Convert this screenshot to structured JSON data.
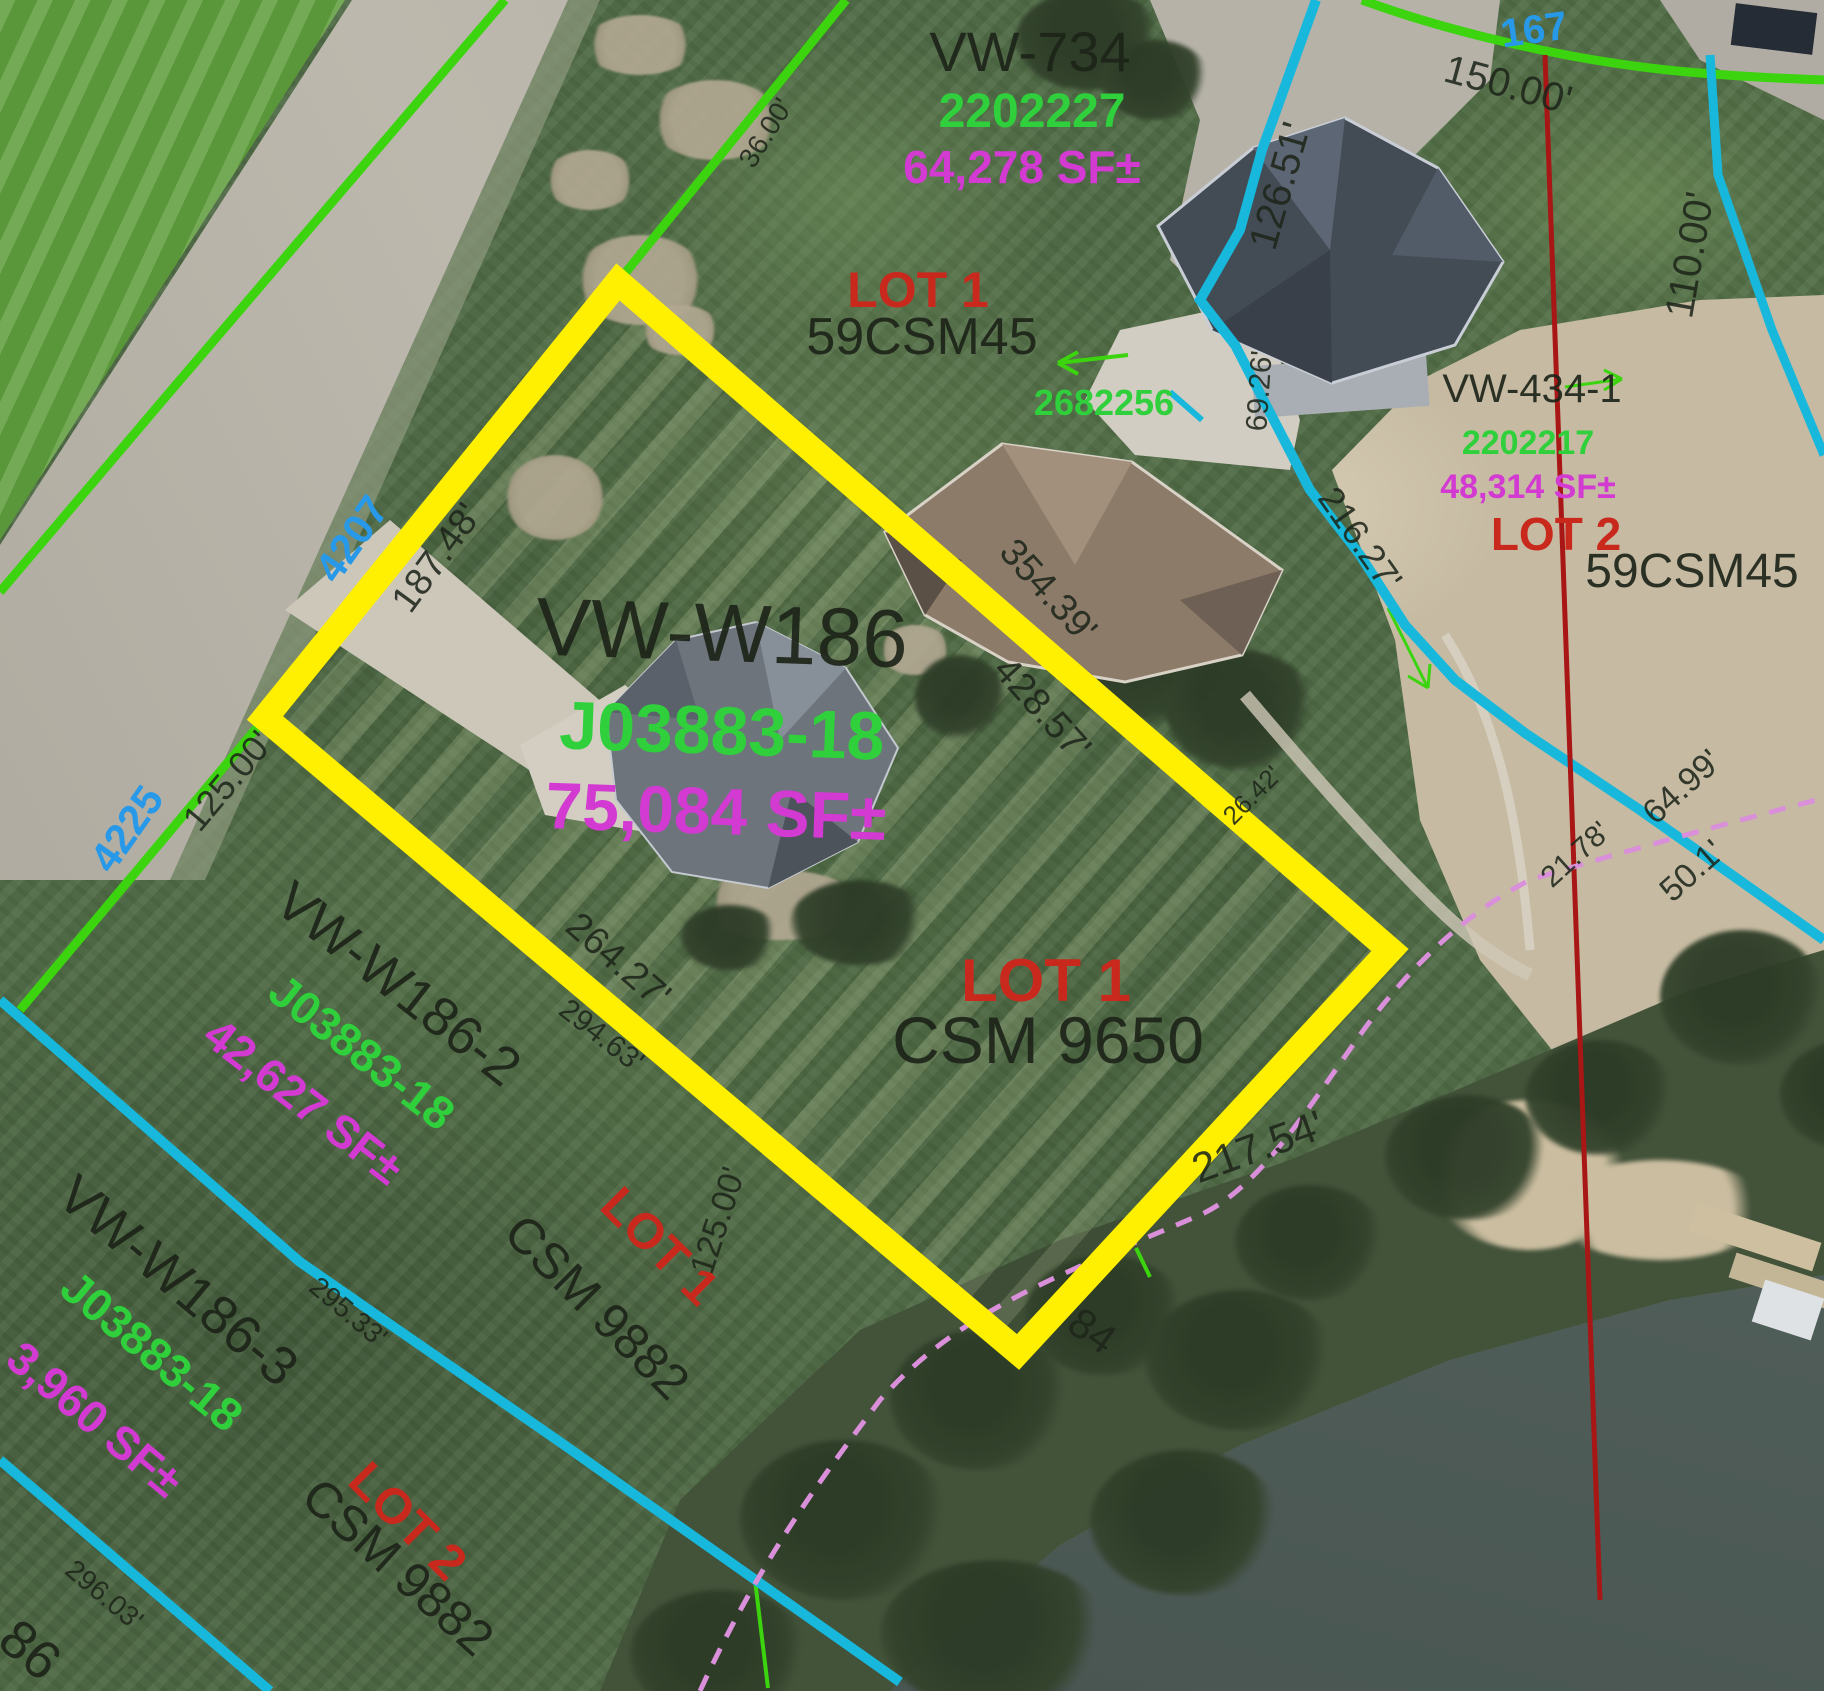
{
  "parcels": {
    "vw734": {
      "name": "VW-734",
      "parcel_id": "2202227",
      "area": "64,278 SF±",
      "lot": "LOT 1",
      "csm": "59CSM45"
    },
    "w186": {
      "name": "VW-W186",
      "parcel_id": "J03883-18",
      "area": "75,084 SF±",
      "lot": "LOT 1",
      "csm": "CSM 9650"
    },
    "w186_2": {
      "name": "VW-W186-2",
      "parcel_id": "J03883-18",
      "area": "42,627 SF±",
      "lot": "LOT 1",
      "csm": "CSM 9882"
    },
    "w186_3": {
      "name": "VW-W186-3",
      "parcel_id": "J03883-18",
      "area": "3,960 SF±",
      "lot": "LOT 2",
      "csm": "CSM 9882"
    },
    "vw434": {
      "name": "VW-434-1",
      "parcel_id": "2202217",
      "area": "48,314 SF±",
      "lot": "LOT 2",
      "csm": "59CSM45"
    }
  },
  "fragments": {
    "corner_text": "86"
  },
  "addresses": {
    "a4207": "4207",
    "a4225": "4225",
    "a167": "167"
  },
  "survey_pin": "2682256",
  "dimensions": {
    "d36": "36.00'",
    "d187_48": "187.48'",
    "d125_00_road": "125.00'",
    "d264_27": "264.27'",
    "d294_63": "294.63'",
    "d354_39": "354.39'",
    "d428_57": "428.57'",
    "d295_33": "295.33'",
    "d296_03": "296.03'",
    "d125_00_side": "125.00'",
    "d217_54": "217.54'",
    "d84": "84",
    "d150_00": "150.00'",
    "d126_51": "126.51'",
    "d110_00": "110.00'",
    "d69_26": "69.26'",
    "d216_27": "216.27'",
    "d26_42": "26.42'",
    "d21_78": "21.78'",
    "d64_99": "64.99'",
    "d50_1": "50.1'"
  },
  "colors": {
    "highlight_yellow": "#ffef00",
    "parcel_line_green": "#3bd40e",
    "parcel_line_cyan": "#17b8dc",
    "section_line_red": "#a81616",
    "shoreline_dash_magenta": "#d98fd9",
    "label_dark": "#1c241c",
    "label_green": "#2fd03c",
    "label_magenta": "#d23ad2",
    "label_red": "#c9291d",
    "label_blue": "#2799e8"
  }
}
